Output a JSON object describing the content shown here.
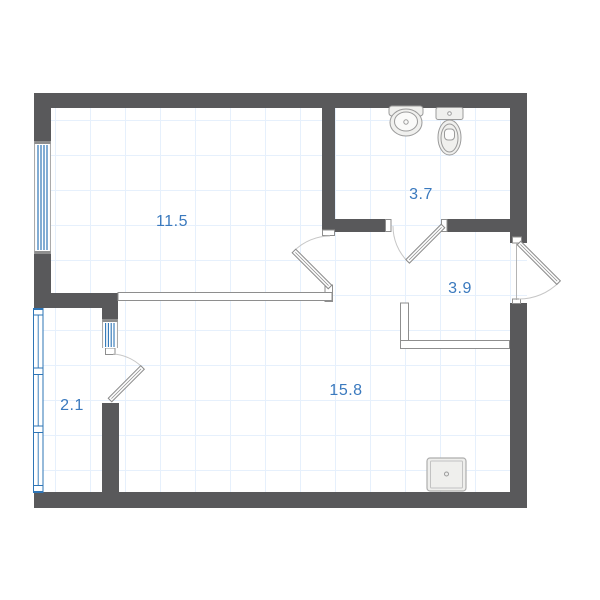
{
  "plan": {
    "rooms": [
      {
        "name": "room-living",
        "area_label": "11.5"
      },
      {
        "name": "room-bathroom",
        "area_label": "3.7"
      },
      {
        "name": "room-hallway",
        "area_label": "3.9"
      },
      {
        "name": "room-balcony",
        "area_label": "2.1"
      },
      {
        "name": "room-kitchen-living",
        "area_label": "15.8"
      }
    ],
    "fixtures": [
      "sink",
      "toilet",
      "floor-drain"
    ],
    "doors": [
      "living-door",
      "bathroom-door",
      "balcony-door",
      "entrance-door"
    ],
    "windows": [
      "living-window",
      "balcony-block-window",
      "balcony-glazing"
    ],
    "colors": {
      "wall": "#59595B",
      "window_blue": "#2E75B6",
      "label_blue": "#3A79BE",
      "grid_blue": "#E6F0FC",
      "swing_arc": "#C6C6C6",
      "thin_outline": "#8E8E8E",
      "fixture_fill": "#F0F0EE",
      "fixture_stroke": "#9B9B9B"
    }
  }
}
